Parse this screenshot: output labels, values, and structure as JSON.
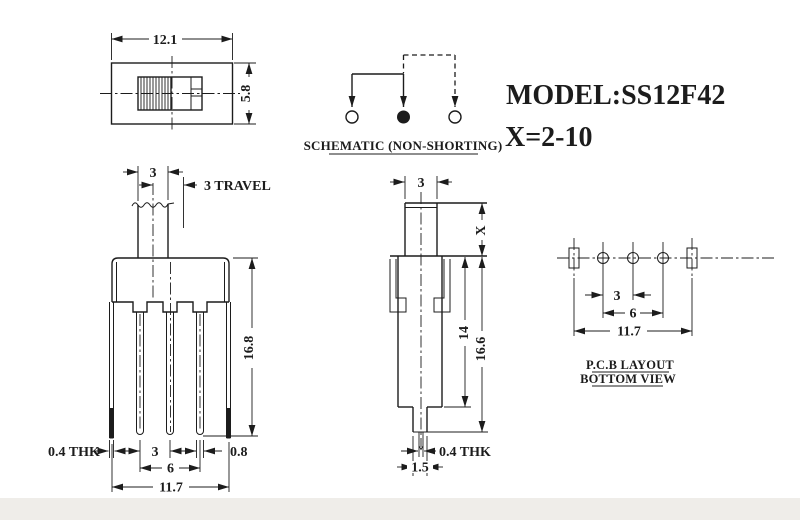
{
  "labels": {
    "model": "MODEL:SS12F42",
    "x_spec": "X=2-10"
  },
  "schematic": {
    "caption": "SCHEMATIC (NON-SHORTING)"
  },
  "top_view": {
    "width": "12.1",
    "height": "5.8"
  },
  "front_view": {
    "knob_width": "3",
    "travel": "3 TRAVEL",
    "height": "16.8",
    "thk": "0.4 THK",
    "pitch": "3",
    "span": "6",
    "pin_w": "0.8",
    "overall": "11.7"
  },
  "side_view": {
    "knob_width": "3",
    "knob_h": "X",
    "body_h": "14",
    "total_h": "16.6",
    "thk": "0.4 THK",
    "tip_w": "1.5"
  },
  "pcb": {
    "pitch": "3",
    "span": "6",
    "overall": "11.7",
    "cap1": "P.C.B LAYOUT",
    "cap2": "BOTTOM VIEW"
  },
  "colors": {
    "line": "#1c1c1c",
    "bg": "#ffffff",
    "band": "#efede9"
  }
}
